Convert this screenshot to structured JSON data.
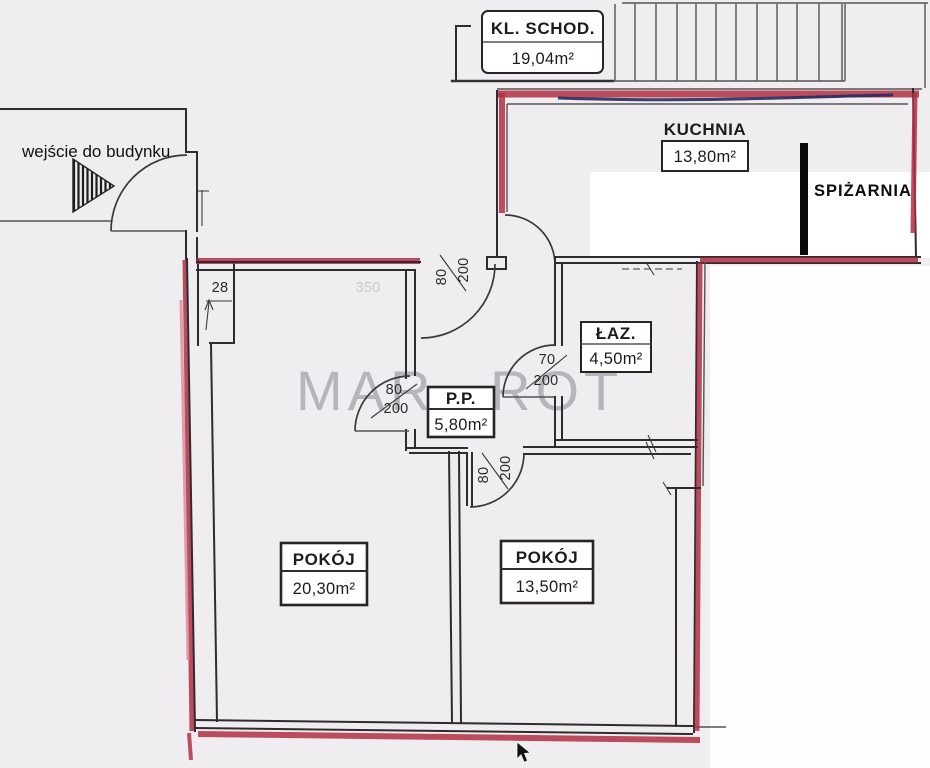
{
  "plan": {
    "entrance": {
      "label": "wejście do budynku"
    },
    "watermark": {
      "text": "MAR ROT",
      "color": "#b6b5bb"
    },
    "rooms": {
      "staircase": {
        "name": "KL. SCHOD.",
        "area": "19,04m²"
      },
      "kitchen": {
        "name": "KUCHNIA",
        "area": "13,80m²"
      },
      "pantry": {
        "name": "SPIŻARNIA"
      },
      "bathroom": {
        "name": "ŁAZ.",
        "area": "4,50m²"
      },
      "hall": {
        "name": "P.P.",
        "area": "5,80m²"
      },
      "room_large": {
        "name": "POKÓJ",
        "area": "20,30m²"
      },
      "room_small": {
        "name": "POKÓJ",
        "area": "13,50m²"
      }
    },
    "dims": {
      "entry_door": {
        "w": "80",
        "h": "200"
      },
      "room_large_door": {
        "w": "80",
        "h": "200"
      },
      "room_small_door": {
        "w": "80",
        "h": "200"
      },
      "bath_door": {
        "w": "70",
        "h": "200"
      },
      "wall_offset": "28",
      "faint_width": "350"
    },
    "colors": {
      "wall_highlight": "#b12f44",
      "wall_highlight_light": "#da8a9b",
      "accent_navy": "#272b62",
      "background": "#efedef"
    }
  }
}
